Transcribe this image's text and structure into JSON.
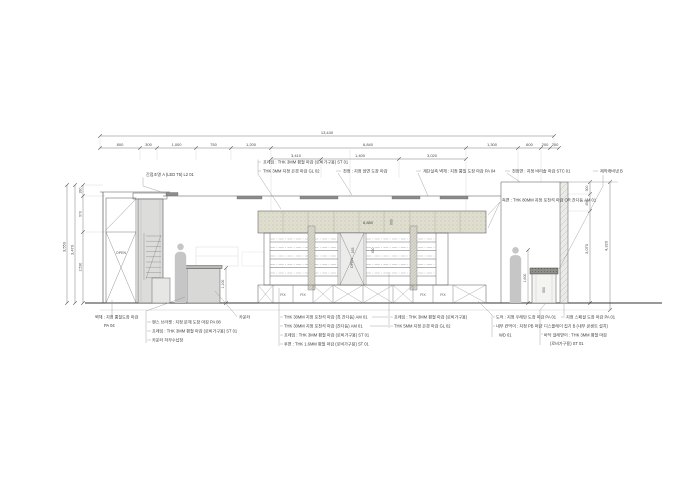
{
  "drawing": {
    "type": "interior-elevation-section",
    "colors": {
      "line": "#4d4d4d",
      "dim_line": "#8a8a8a",
      "stone_band": "#dfdecf",
      "column_fill": "#dcdcda",
      "person_fill": "#c6c6c6",
      "wall_hatch": "#eaeae7",
      "light_fixture": "#8d8d8d"
    },
    "dims": {
      "total_width": "13,440",
      "row2": [
        "800",
        "300",
        "1,000",
        "750",
        "1,200",
        "6,840",
        "1,300",
        "600",
        "200",
        "200"
      ],
      "row3": [
        "3,410",
        "1,400",
        "3,020"
      ],
      "left": {
        "outer": "3,550",
        "inner": "3,470",
        "seg": [
          "280",
          "970",
          "2,530"
        ]
      },
      "right": {
        "outer": "4,320",
        "seg": [
          "300",
          "450",
          "3,070"
        ]
      },
      "band_w": "6,880",
      "band_h": "600",
      "counter_h": "1,100",
      "mid_a": "165",
      "mid_b": "450",
      "right_h": "1,600",
      "cab_w": "550"
    },
    "labels": {
      "open": "OPEN",
      "fix": "FIX"
    },
    "callouts": {
      "top": [
        "간접조명 A (LED T5) L2 01",
        "프레임 : THK 3MM 평철 마감 (로비가구용) ST 01",
        "THK 3MM 지정 은경 마감 GL 02",
        "천정 : 지정 암면 도장 마감",
        "계단실측 벽체 : 지정 뿜칠 도장 마감 PA 04",
        "천장면 : 지정 바리솔 마감 STC 01",
        "제작캐비넷 B"
      ],
      "side": "측면 : THK 80MM 지정 포천석 마감 OR 잔다듬 AM 01",
      "bottom_left": {
        "wall_l1": "벽체 : 지정 뿜칠도장 마감",
        "wall_l2": "PA 04",
        "counter": "카운터",
        "items": [
          "펜스 브라켓 : 지정 분체 도장 마감 PA 08",
          "프레임 : THK 3MM 평철 마감 (로비가구용) ST 01",
          "카운터 하부수납장"
        ]
      },
      "bottom_mid": [
        "THK 30MM 지정 포천석 마감 (혹 잔다듬) AM 01",
        "THK 30MM 지정 포천석 마감 (잔다듬) AM 01",
        "프레임 : THK 3MM 평철 마감 (로비가구용) ST 01",
        "후면 : THK 1.6MM 평철 마감 (로비가구용) ST 01"
      ],
      "bottom_mid2": [
        "프레임 : THK 3MM 평철 마감 (로비가구용)",
        "THK 5MM 지정 은경 마감 GL 02"
      ],
      "bottom_right": [
        "도어 : 지정 우레탄 도장 마감 PA 01",
        "내부 칸막이 : 지정 PB 마감",
        "WD 01"
      ],
      "bottom_right2": [
        "지정 스페셜 도장 마감 PA 01",
        "디스플레이 집기 B (내부 콘센트 설치)",
        "바닥 걸레받이 : THK 3MM 평철 마감",
        "(로비가구용) ST 01"
      ]
    }
  }
}
